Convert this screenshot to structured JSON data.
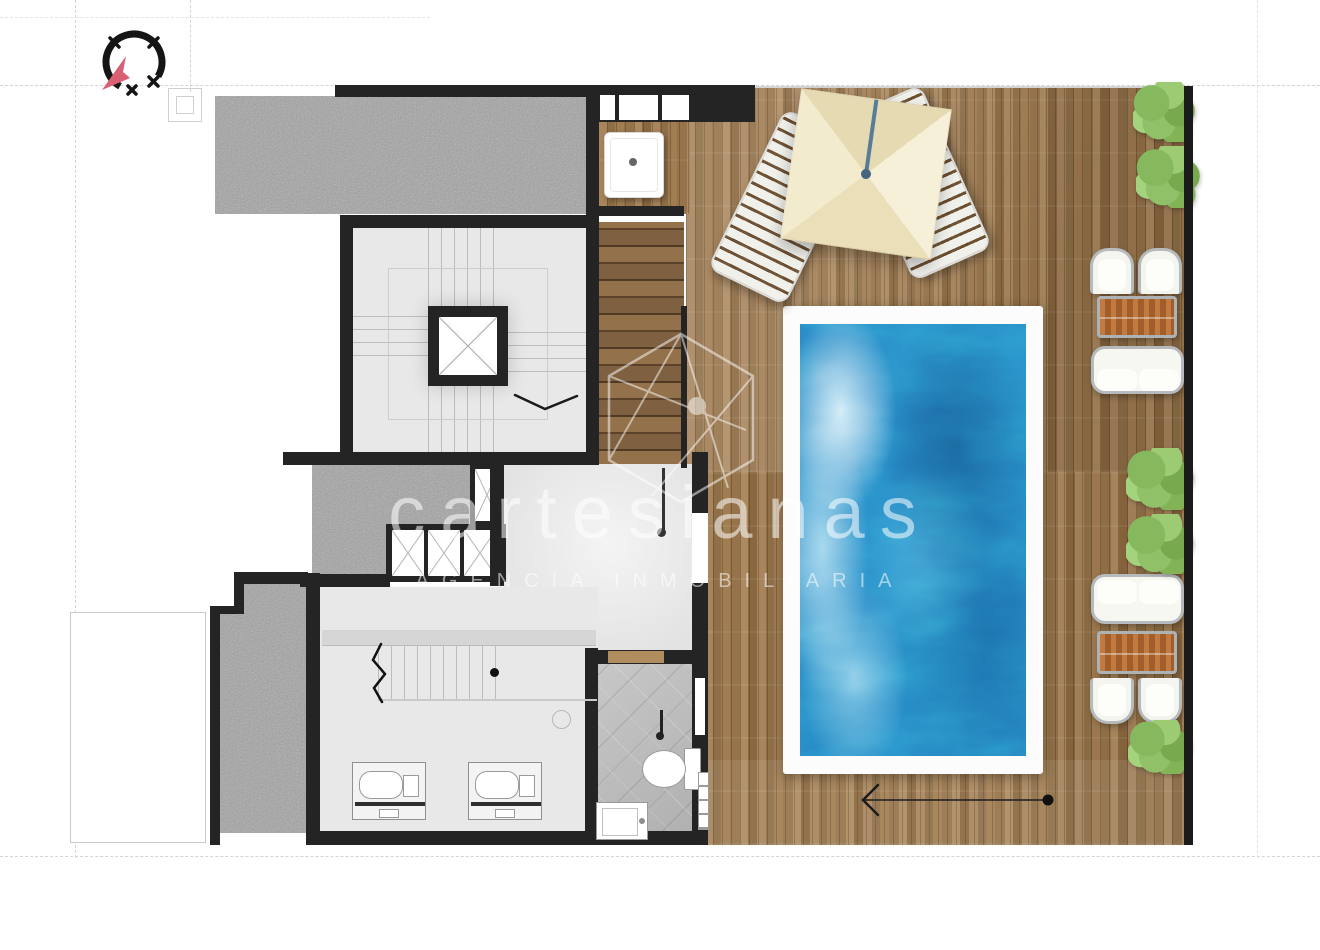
{
  "watermark": {
    "brand": "cartesianas",
    "subtitle": "AGENCIA INMOBILIARIA"
  },
  "icons": {
    "compass": "north-arrow-compass-icon",
    "logo": "hexagon-geometric-logo"
  },
  "colors": {
    "wall_black": "#242424",
    "deck_wood": "#9c7a50",
    "stair_wood": "#8a6a44",
    "pool_water_blue": "#2789c6",
    "pool_coping_white": "#fcfcfc",
    "gravel_gray": "#a2a2a2",
    "interior_floor_gray": "#e8e8e8",
    "bathroom_tile_gray": "#bdbdbd",
    "plant_green": "#86b95e",
    "umbrella_canvas_cream": "#f1e7c6",
    "table_wood_orange": "#b56f38",
    "compass_arrow_pink": "#d95f72",
    "watermark_white": "rgba(255,255,255,0.55)"
  }
}
